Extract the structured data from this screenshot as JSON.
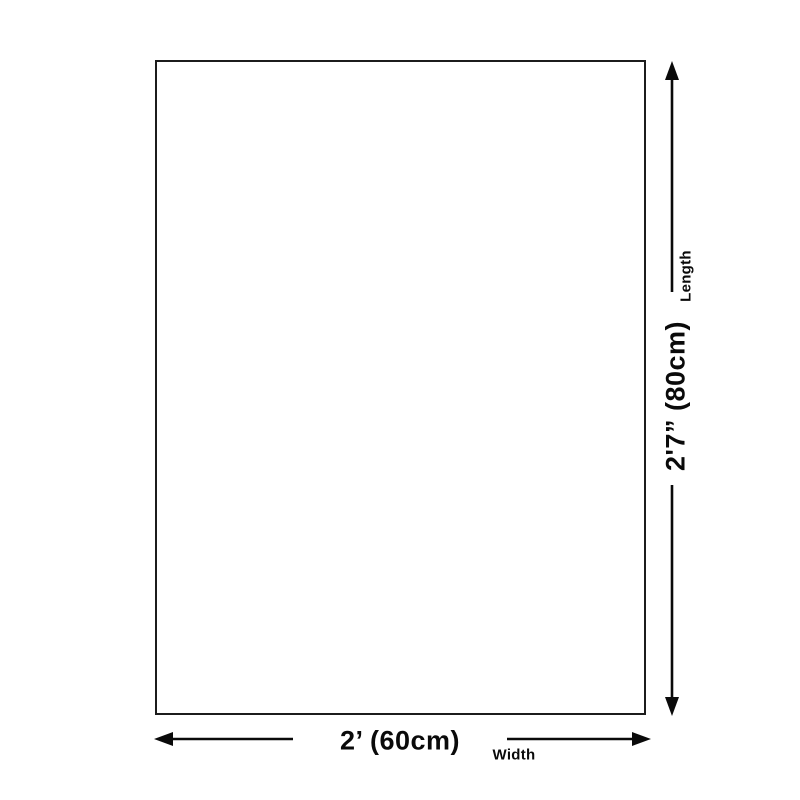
{
  "diagram": {
    "title": "product-size-diagram",
    "width_value": "2’ (60cm)",
    "width_label": "Width",
    "length_value": "2'7” (80cm)",
    "length_label": "Length",
    "line_color": "#0a0a0a",
    "rect_border_color": "#1c1c1c",
    "background_color": "#ffffff"
  }
}
